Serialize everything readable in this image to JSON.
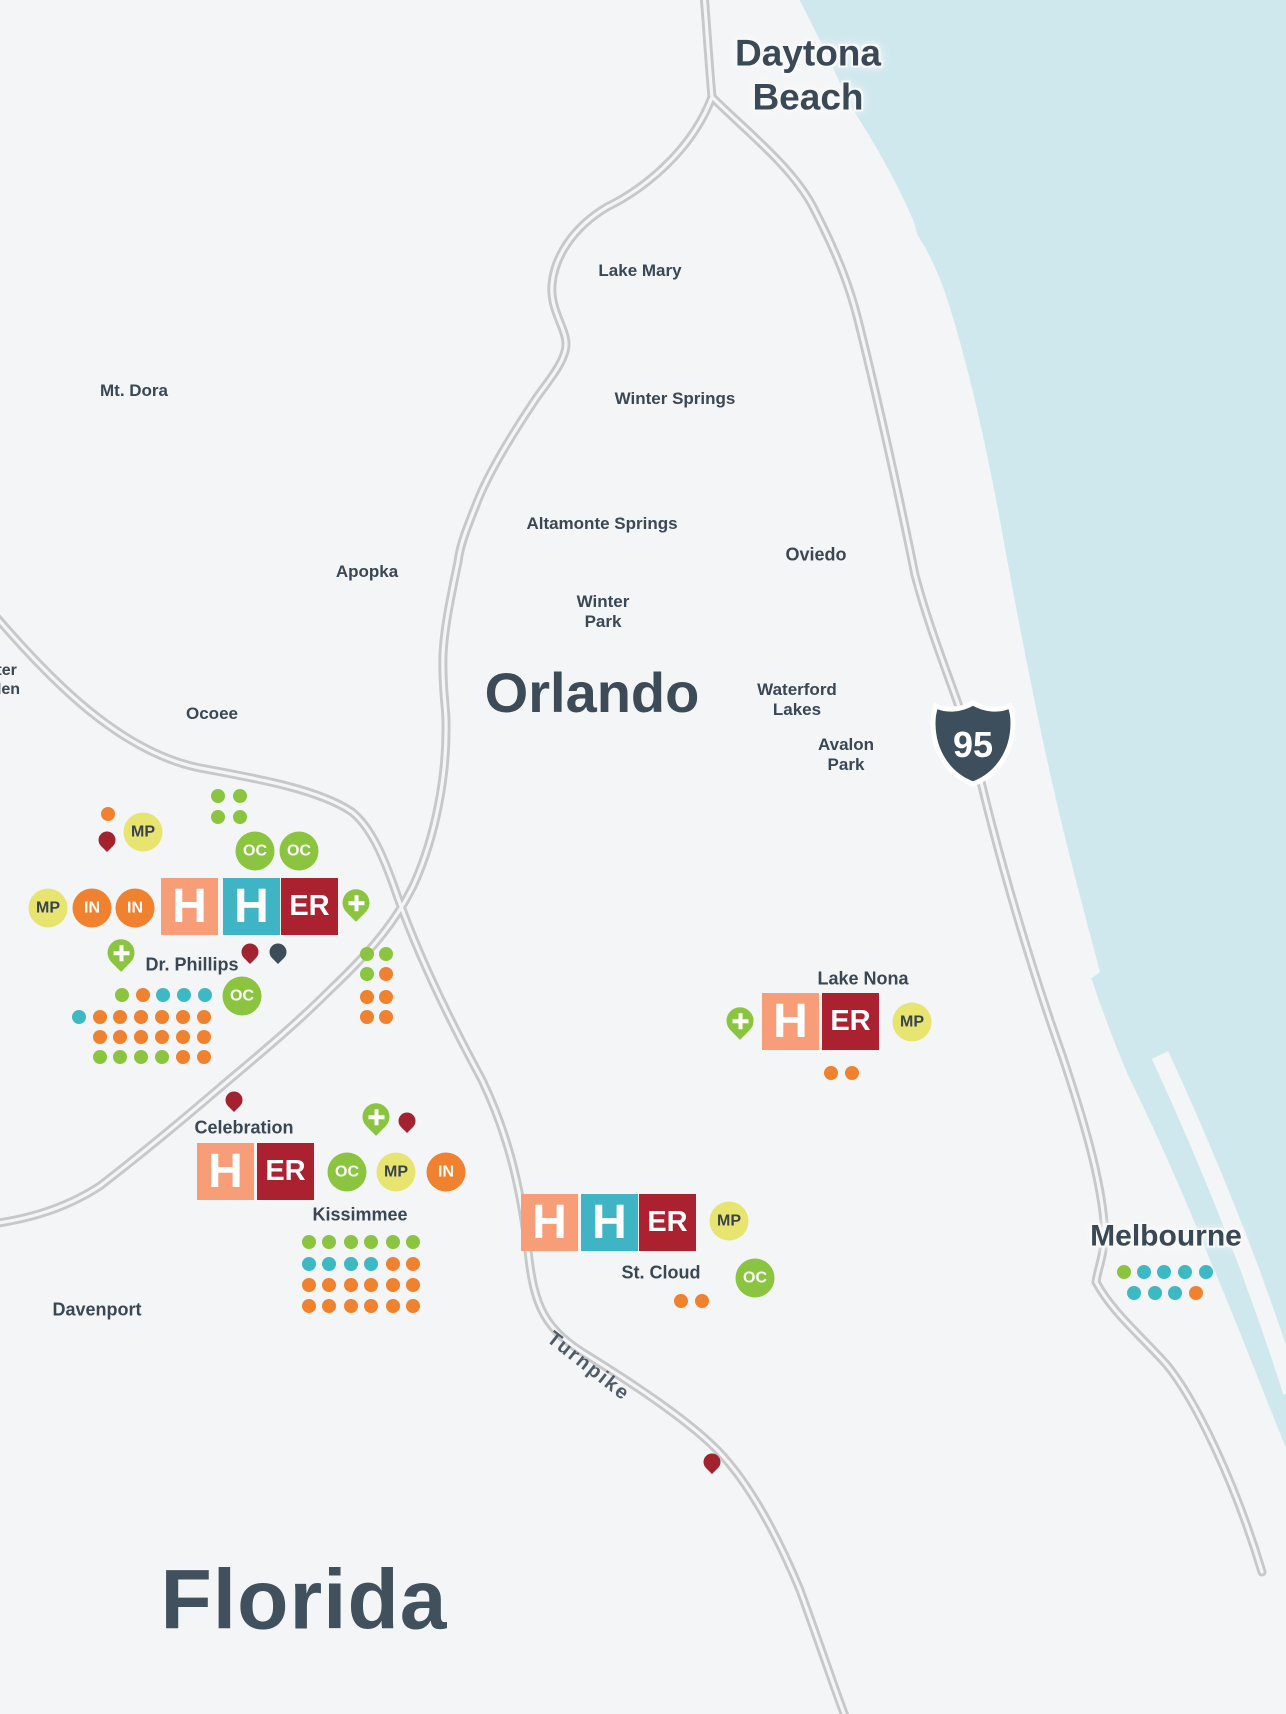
{
  "map": {
    "labels": {
      "daytona_beach": "Daytona\nBeach",
      "lake_mary": "Lake Mary",
      "winter_springs": "Winter Springs",
      "mt_dora": "Mt. Dora",
      "altamonte_springs": "Altamonte Springs",
      "apopka": "Apopka",
      "oviedo": "Oviedo",
      "winter_park": "Winter\nPark",
      "orlando": "Orlando",
      "waterford_lakes": "Waterford\nLakes",
      "avalon_park": "Avalon\nPark",
      "winter_garden": "Winter\nGarden",
      "ocoee": "Ocoee",
      "dr_phillips": "Dr. Phillips",
      "celebration": "Celebration",
      "kissimmee": "Kissimmee",
      "davenport": "Davenport",
      "st_cloud": "St. Cloud",
      "lake_nona": "Lake Nona",
      "melbourne": "Melbourne",
      "florida": "Florida",
      "turnpike": "Turnpike",
      "interstate_95": "95"
    },
    "badges": {
      "h": "H",
      "er": "ER",
      "oc": "OC",
      "mp": "MP",
      "in": "IN"
    },
    "colors": {
      "land": "#f4f5f6",
      "water": "#cfe8ee",
      "road": "#c7c8ca",
      "label_dark": "#3a4754",
      "hospital_salmon": "#f79e78",
      "hospital_teal": "#3fb4c4",
      "er_crimson": "#ac2130",
      "oc_green": "#8bc540",
      "mp_yellow": "#e7e470",
      "in_orange": "#f0812e",
      "dot_teal": "#3db9c3",
      "pin_red": "#a32230",
      "pin_dark": "#3d4c59",
      "shield_slate": "#3d4f5c"
    },
    "markers": {
      "blocks": [
        {
          "x": 161,
          "y": 878,
          "t": "h_salmon"
        },
        {
          "x": 223,
          "y": 878,
          "t": "h_teal"
        },
        {
          "x": 281,
          "y": 878,
          "t": "er"
        },
        {
          "x": 197,
          "y": 1143,
          "t": "h_salmon"
        },
        {
          "x": 257,
          "y": 1143,
          "t": "er"
        },
        {
          "x": 521,
          "y": 1194,
          "t": "h_salmon"
        },
        {
          "x": 581,
          "y": 1194,
          "t": "h_teal"
        },
        {
          "x": 639,
          "y": 1194,
          "t": "er"
        },
        {
          "x": 762,
          "y": 993,
          "t": "h_salmon"
        },
        {
          "x": 822,
          "y": 993,
          "t": "er"
        }
      ],
      "circles": [
        {
          "x": 255,
          "y": 851,
          "t": "oc"
        },
        {
          "x": 299,
          "y": 851,
          "t": "oc"
        },
        {
          "x": 242,
          "y": 996,
          "t": "oc"
        },
        {
          "x": 347,
          "y": 1172,
          "t": "oc"
        },
        {
          "x": 755,
          "y": 1278,
          "t": "oc"
        },
        {
          "x": 143,
          "y": 832,
          "t": "mp"
        },
        {
          "x": 48,
          "y": 908,
          "t": "mp"
        },
        {
          "x": 396,
          "y": 1172,
          "t": "mp"
        },
        {
          "x": 729,
          "y": 1221,
          "t": "mp"
        },
        {
          "x": 912,
          "y": 1022,
          "t": "mp"
        },
        {
          "x": 92,
          "y": 908,
          "t": "in"
        },
        {
          "x": 135,
          "y": 908,
          "t": "in"
        },
        {
          "x": 446,
          "y": 1172,
          "t": "in"
        }
      ],
      "pins": [
        {
          "x": 356,
          "y": 900,
          "t": "plus"
        },
        {
          "x": 121,
          "y": 950,
          "t": "plus"
        },
        {
          "x": 376,
          "y": 1114,
          "t": "plus"
        },
        {
          "x": 740,
          "y": 1018,
          "t": "plus"
        },
        {
          "x": 107,
          "y": 836,
          "t": "red"
        },
        {
          "x": 250,
          "y": 948,
          "t": "red"
        },
        {
          "x": 234,
          "y": 1096,
          "t": "red"
        },
        {
          "x": 407,
          "y": 1117,
          "t": "red"
        },
        {
          "x": 712,
          "y": 1458,
          "t": "red"
        },
        {
          "x": 278,
          "y": 948,
          "t": "dark"
        }
      ],
      "dots": [
        [
          108,
          814,
          "o"
        ],
        [
          218,
          796,
          "g"
        ],
        [
          240,
          796,
          "g"
        ],
        [
          218,
          817,
          "g"
        ],
        [
          240,
          817,
          "g"
        ],
        [
          122,
          995,
          "g"
        ],
        [
          143,
          995,
          "o"
        ],
        [
          163,
          995,
          "t"
        ],
        [
          184,
          995,
          "t"
        ],
        [
          205,
          995,
          "t"
        ],
        [
          79,
          1017,
          "t"
        ],
        [
          100,
          1017,
          "o"
        ],
        [
          120,
          1017,
          "o"
        ],
        [
          141,
          1017,
          "o"
        ],
        [
          162,
          1017,
          "o"
        ],
        [
          183,
          1017,
          "o"
        ],
        [
          204,
          1017,
          "o"
        ],
        [
          100,
          1037,
          "o"
        ],
        [
          120,
          1037,
          "o"
        ],
        [
          141,
          1037,
          "o"
        ],
        [
          162,
          1037,
          "o"
        ],
        [
          183,
          1037,
          "o"
        ],
        [
          204,
          1037,
          "o"
        ],
        [
          100,
          1057,
          "g"
        ],
        [
          120,
          1057,
          "g"
        ],
        [
          141,
          1057,
          "g"
        ],
        [
          162,
          1057,
          "g"
        ],
        [
          183,
          1057,
          "o"
        ],
        [
          204,
          1057,
          "o"
        ],
        [
          367,
          954,
          "g"
        ],
        [
          386,
          954,
          "g"
        ],
        [
          367,
          974,
          "g"
        ],
        [
          386,
          974,
          "o"
        ],
        [
          367,
          997,
          "o"
        ],
        [
          386,
          997,
          "o"
        ],
        [
          367,
          1017,
          "o"
        ],
        [
          386,
          1017,
          "o"
        ],
        [
          309,
          1242,
          "g"
        ],
        [
          329,
          1242,
          "g"
        ],
        [
          351,
          1242,
          "g"
        ],
        [
          371,
          1242,
          "g"
        ],
        [
          393,
          1242,
          "g"
        ],
        [
          413,
          1242,
          "g"
        ],
        [
          309,
          1264,
          "t"
        ],
        [
          329,
          1264,
          "t"
        ],
        [
          351,
          1264,
          "t"
        ],
        [
          371,
          1264,
          "t"
        ],
        [
          393,
          1264,
          "o"
        ],
        [
          413,
          1264,
          "o"
        ],
        [
          309,
          1285,
          "o"
        ],
        [
          329,
          1285,
          "o"
        ],
        [
          351,
          1285,
          "o"
        ],
        [
          371,
          1285,
          "o"
        ],
        [
          393,
          1285,
          "o"
        ],
        [
          413,
          1285,
          "o"
        ],
        [
          309,
          1306,
          "o"
        ],
        [
          329,
          1306,
          "o"
        ],
        [
          351,
          1306,
          "o"
        ],
        [
          371,
          1306,
          "o"
        ],
        [
          393,
          1306,
          "o"
        ],
        [
          413,
          1306,
          "o"
        ],
        [
          681,
          1301,
          "o"
        ],
        [
          702,
          1301,
          "o"
        ],
        [
          831,
          1073,
          "o"
        ],
        [
          852,
          1073,
          "o"
        ],
        [
          1124,
          1272,
          "g"
        ],
        [
          1144,
          1272,
          "t"
        ],
        [
          1164,
          1272,
          "t"
        ],
        [
          1185,
          1272,
          "t"
        ],
        [
          1206,
          1272,
          "t"
        ],
        [
          1134,
          1293,
          "t"
        ],
        [
          1155,
          1293,
          "t"
        ],
        [
          1175,
          1293,
          "t"
        ],
        [
          1196,
          1293,
          "o"
        ]
      ]
    }
  }
}
